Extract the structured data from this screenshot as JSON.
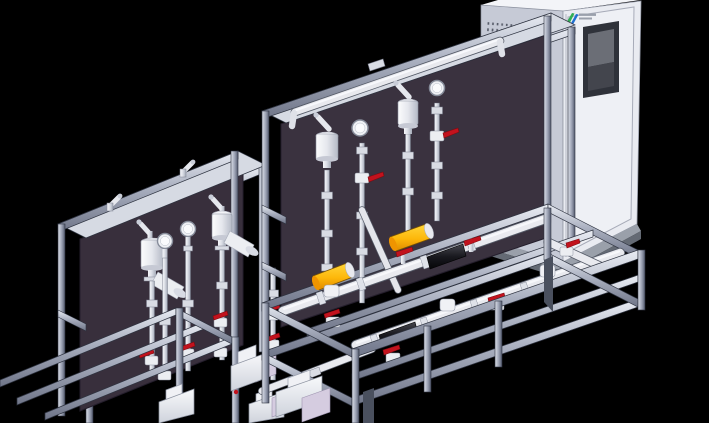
{
  "meta": {
    "type": "3d-cad-render-of-chemical-dosing-system",
    "width": 709,
    "height": 423,
    "background": "#000000"
  },
  "palette": {
    "background": "#000000",
    "panel": "#3a323f",
    "panel_left": "#382f3c",
    "frame_light": "#dfe3ec",
    "frame_mid": "#a9afc0",
    "frame_dark": "#2e3340",
    "pipe": "#e8e9ee",
    "pipe_shadow": "#9ba1af",
    "fitting": "#d9dce4",
    "red": "#c2121d",
    "red_dark": "#7e0a10",
    "yellow": "#ffc21a",
    "yellow_deep": "#ef9400",
    "black_pump": "#17171c",
    "lavender": "#d5cce0",
    "gusset": "#4a505e",
    "cabinet_top": "#f3f4f8",
    "cabinet_side": "#c6cad6",
    "cabinet_front": "#e9ebf1",
    "cabinet_door": "#eef0f5",
    "cabinet_base": "#9aa0aa",
    "cabinet_base_dark": "#646a74",
    "vent_dot": "#585d6a",
    "screen_frame": "#2f323a",
    "screen_glass": "#6b6e76",
    "screen_lower": "#43454d",
    "logo_green": "#2fae54",
    "logo_blue": "#1f6fd0",
    "logo_text_bar": "#9aa0ac",
    "gauge_face": "#eff1f5"
  },
  "cabinet": {
    "name": "control-cabinet",
    "vent_bands": 5,
    "display_screen": true,
    "door": true,
    "logo_colors": [
      "#2fae54",
      "#1f6fd0"
    ]
  },
  "left_skid": {
    "name": "dosing-skid-left",
    "pulse_dampeners": 2,
    "pressure_gauges": 2,
    "angled_bottles": 2,
    "red_hand_valves": 7,
    "metering_pumps": 3
  },
  "center_skid": {
    "name": "dosing-skid-center",
    "pulse_dampeners": 2,
    "pressure_gauges": 2,
    "yellow_dampeners": 2,
    "pump_lines": 2,
    "red_hand_valves": 8,
    "top_header_pipe": true
  }
}
